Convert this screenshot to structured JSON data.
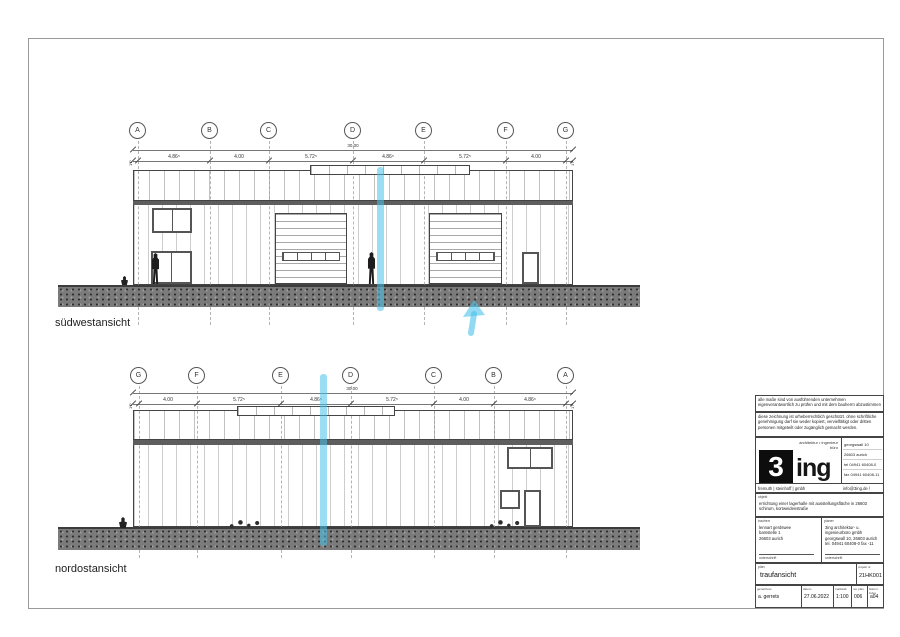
{
  "views": {
    "sw": {
      "label": "südwestansicht",
      "grid": [
        "A",
        "B",
        "C",
        "D",
        "E",
        "F",
        "G"
      ],
      "total": "30.00",
      "dims": [
        "4.86⁵",
        "4.00",
        "5.72⁵",
        "4.86⁵",
        "5.72⁵",
        "4.00"
      ],
      "end_left": "17⁵",
      "end_right": "17⁵"
    },
    "no": {
      "label": "nordostansicht",
      "grid": [
        "G",
        "F",
        "E",
        "D",
        "C",
        "B",
        "A"
      ],
      "total": "30.00",
      "dims": [
        "4.00",
        "5.72⁵",
        "4.86⁵",
        "5.72⁵",
        "4.00",
        "4.86⁵"
      ],
      "end_left": "17⁵",
      "end_right": "17⁵"
    }
  },
  "highlight": {
    "color": "#49c3ea"
  },
  "titleblock": {
    "note1": "alle maße sind von ausführenden unternehmen eigenverantwortlich zu prüfen und mit dem bauherrn abzustimmen",
    "note2": "diese zeichnung ist urheberrechtlich geschützt. ohne schriftliche genehmigung darf sie weder kopiert, vervielfältigt oder dritten personen mitgeteilt oder zugänglich gemacht werden.",
    "logo": {
      "mark": "3",
      "mark_suffix": "ing",
      "tagline": "architektur • ingenieur büro",
      "contact": [
        "georgswall 10",
        "26603 aurich",
        "tel 04941 60408-0",
        "fax 04941 60408-11"
      ],
      "firm": "fremuth | steinhoff | gmbh",
      "web": "info@3ing.de / www.3ing.de"
    },
    "objekt": {
      "label": "objekt",
      "text": "errichtung einer lagerhalle mit ausstellungsfläche in 26603 schirum, kortweidenstraße"
    },
    "bauherr": {
      "label": "bauherr",
      "line1": "lennart gerdswee",
      "line2": "barsstelle 1",
      "line3": "26603 aurich",
      "sign": "unterschrift"
    },
    "planer": {
      "label": "planer",
      "line1": "3ing architektur- u. ingenieurbüro gmbh",
      "line2": "georgswall 10, 26603 aurich",
      "line3": "tel. 04941 60408-0  fax -11",
      "sign": "unterschrift"
    },
    "plan": {
      "label": "plan",
      "value": "traufansicht"
    },
    "projekt": {
      "label": "projekt nr.",
      "value": "21HK001"
    },
    "cells": [
      {
        "label": "gezeichnet",
        "value": "a. gerrets"
      },
      {
        "label": "datum",
        "value": "27.06.2022"
      },
      {
        "label": "maßstab",
        "value": "1:100"
      },
      {
        "label": "nor plan",
        "value": "006"
      },
      {
        "label": "blatt nr. index",
        "value": "a04"
      }
    ]
  }
}
